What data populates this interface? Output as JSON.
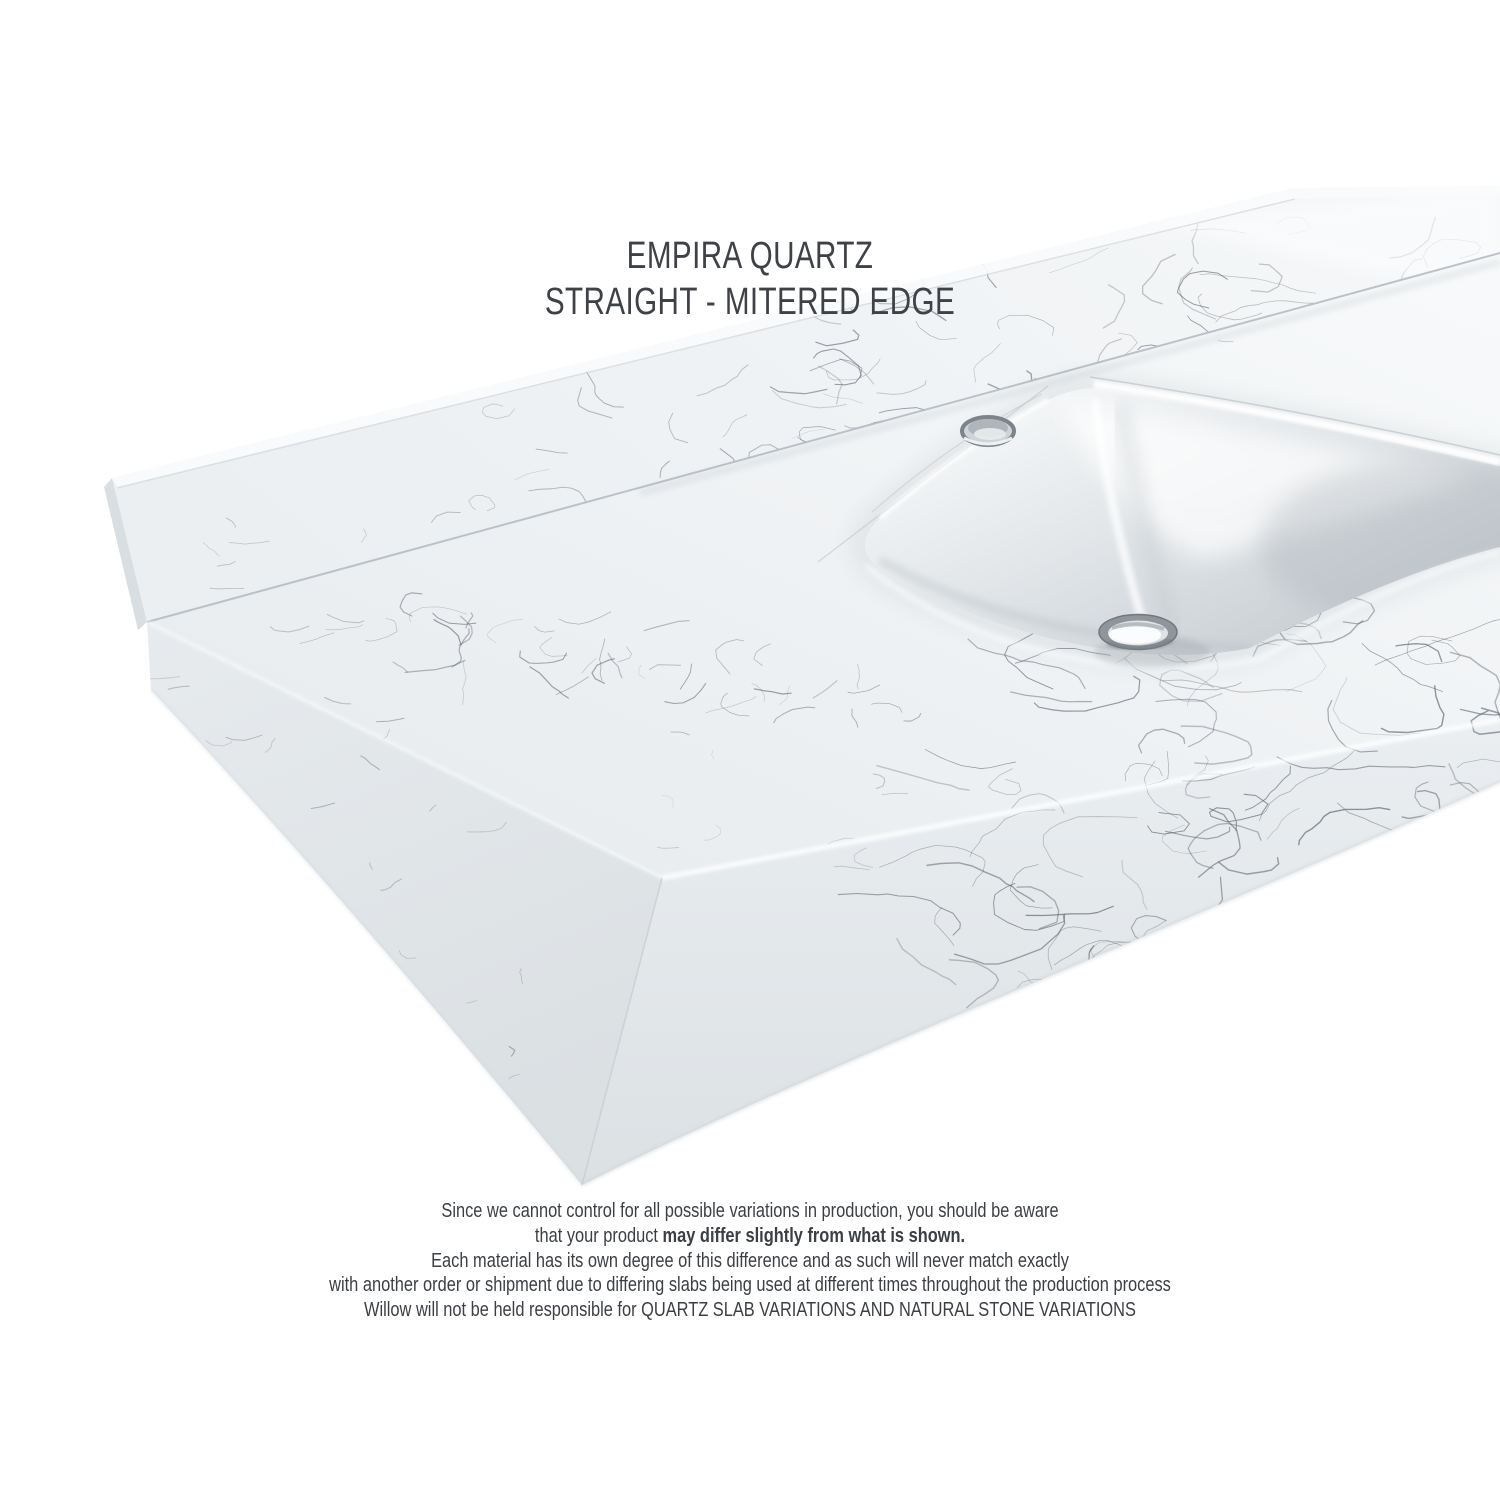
{
  "page": {
    "background": "#ffffff"
  },
  "title": {
    "line1": "EMPIRA QUARTZ",
    "line2": "STRAIGHT - MITERED EDGE",
    "color": "#3e4247"
  },
  "disclaimer": {
    "line1": "Since we cannot control for all possible variations in production, you should be aware",
    "line2_normal": "that your product ",
    "line2_bold": "may differ slightly from what is shown.",
    "line3": "Each material has its own degree of this difference and as such will never match exactly",
    "line4": "with another order or shipment due to differing slabs being used at different times throughout the production process",
    "line5": "Willow will not be held responsible for QUARTZ SLAB VARIATIONS AND NATURAL STONE VARIATIONS",
    "color": "#3b3f44"
  },
  "product_image": {
    "description": "3D render of a white Empira quartz vanity top with straight mitered edge, matching backsplash, single faucet hole and undermount rectangular sink with chrome drain",
    "parts": [
      "backsplash",
      "countertop-deck",
      "mitered-front-edge",
      "left-end-face",
      "sink-basin",
      "faucet-hole",
      "drain"
    ],
    "palette": {
      "stone_white": "#f2f5f6",
      "stone_shadow": "#dce1e4",
      "vein_gray": "#59616a",
      "basin_gray": "#c6ccd1",
      "chrome": "#8e959b"
    }
  }
}
